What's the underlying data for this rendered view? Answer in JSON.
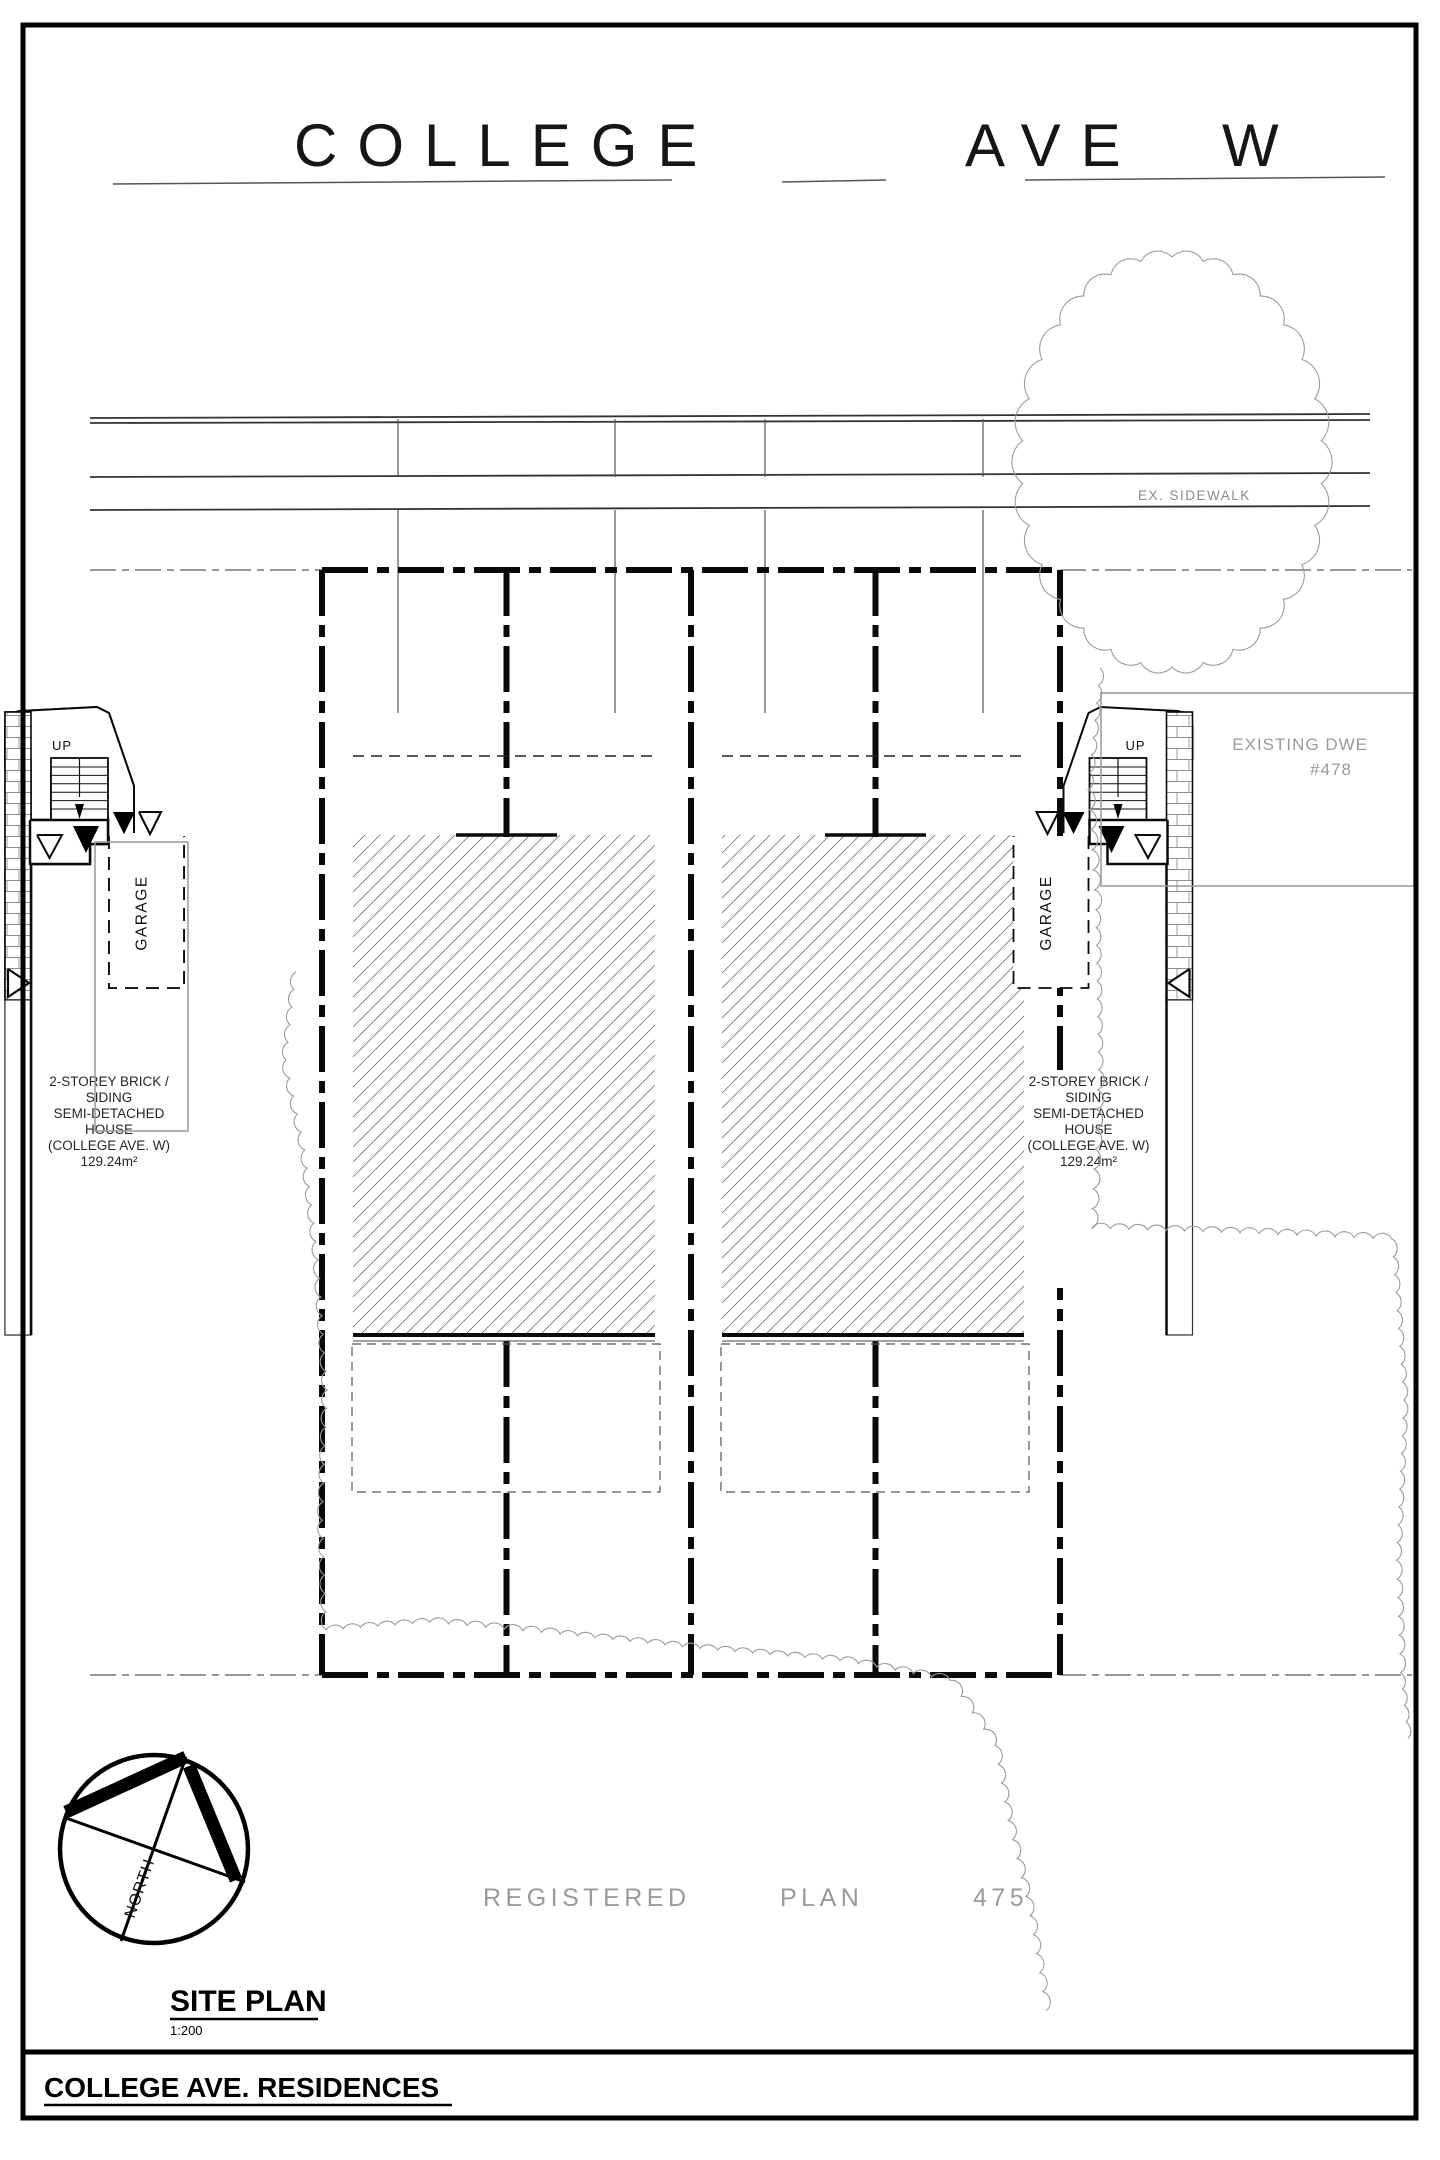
{
  "page": {
    "background": "#ffffff",
    "line_color": "#111111",
    "muted_color": "#9a9a9a"
  },
  "street": {
    "name_words": [
      "COLLEGE",
      "AVE",
      "W"
    ],
    "sidewalk_label": "EX. SIDEWALK"
  },
  "plan": {
    "registered_plan_words": [
      "REGISTERED",
      "PLAN",
      "475"
    ],
    "existing_dwelling": {
      "line1": "EXISTING DWE",
      "line2": "#478"
    },
    "north_label": "NORTH",
    "units": [
      {
        "porch_label": "UP",
        "garage_label": "GARAGE",
        "description": [
          "2-STOREY BRICK /",
          "SIDING",
          "SEMI-DETACHED",
          "HOUSE",
          "(COLLEGE AVE. W)",
          "129.24m²"
        ]
      },
      {
        "porch_label": "UP",
        "garage_label": "GARAGE",
        "description": [
          "2-STOREY BRICK /",
          "SIDING",
          "SEMI-DETACHED",
          "HOUSE",
          "(COLLEGE AVE. W)",
          "129.24m²"
        ]
      },
      {
        "porch_label": "UP",
        "garage_label": "GARAGE",
        "description": [
          "2-STOREY BRICK /",
          "SIDING",
          "SEMI-DETACHED",
          "HOUSE",
          "(COLLEGE AVE. W)",
          "129.24m²"
        ]
      },
      {
        "porch_label": "UP",
        "garage_label": "GARAGE",
        "description": [
          "2-STOREY BRICK /",
          "SIDING",
          "SEMI-DETACHED",
          "HOUSE",
          "(COLLEGE AVE. W)",
          "129.24m²"
        ]
      }
    ]
  },
  "title_block": {
    "sheet_title": "SITE PLAN",
    "scale": "1:200",
    "project_title": "COLLEGE AVE. RESIDENCES"
  }
}
